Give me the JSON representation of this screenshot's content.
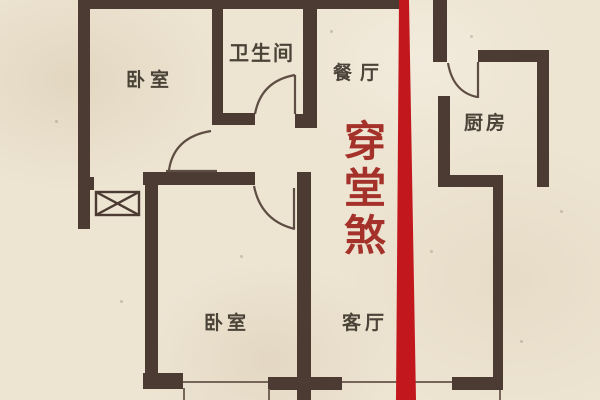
{
  "plan": {
    "title": "apartment-floor-plan",
    "background_color": "#ede4d2",
    "wall_color": "#4b3b32",
    "rooms": [
      {
        "id": "bedroom-top-left",
        "label": "卧室"
      },
      {
        "id": "bathroom",
        "label": "卫生间"
      },
      {
        "id": "dining-room",
        "label": "餐厅"
      },
      {
        "id": "kitchen",
        "label": "厨房"
      },
      {
        "id": "bedroom-bottom",
        "label": "卧室"
      },
      {
        "id": "living-room",
        "label": "客厅"
      }
    ],
    "annotation": {
      "text": "穿堂煞",
      "text_color": "#a5322a",
      "line_color": "#c2181d"
    }
  }
}
